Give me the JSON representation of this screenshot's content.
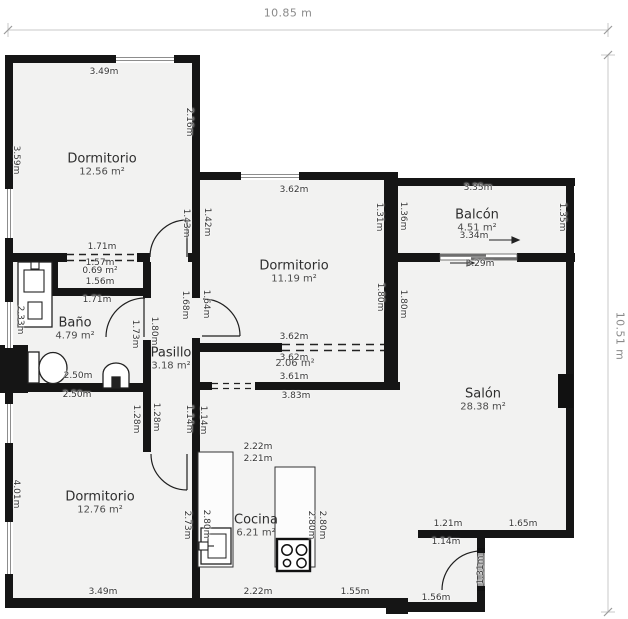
{
  "colors": {
    "wall": "#151515",
    "floor": "#f2f2f1",
    "dim_text": "#353535",
    "outer_dim_text": "#8a8a8a"
  },
  "outer_dimensions": {
    "width": "10.85 m",
    "height": "10.51 m"
  },
  "rooms": [
    {
      "name": "Dormitorio",
      "area": "12.56 m²",
      "x": 102,
      "y": 165
    },
    {
      "name": "Dormitorio",
      "area": "11.19 m²",
      "x": 294,
      "y": 272
    },
    {
      "name": "Balcón",
      "area": "4.51 m²",
      "x": 477,
      "y": 221
    },
    {
      "name": "Baño",
      "area": "4.79 m²",
      "x": 75,
      "y": 329
    },
    {
      "name": "Pasillo",
      "area": "3.18 m²",
      "x": 171,
      "y": 359
    },
    {
      "name": "Salón",
      "area": "28.38 m²",
      "x": 483,
      "y": 400
    },
    {
      "name": "Cocina",
      "area": "6.21 m²",
      "x": 256,
      "y": 526
    },
    {
      "name": "Dormitorio",
      "area": "12.76 m²",
      "x": 100,
      "y": 503
    },
    {
      "name": "",
      "area": "2.06 m²",
      "x": 295,
      "y": 364
    }
  ],
  "dims": [
    {
      "t": "10.85 m",
      "x": 288,
      "y": 13,
      "c": "outer"
    },
    {
      "t": "10.51 m",
      "x": 620,
      "y": 336,
      "v": 1,
      "c": "outer"
    },
    {
      "t": "3.49m",
      "x": 104,
      "y": 72
    },
    {
      "t": "2.16m",
      "x": 189,
      "y": 122,
      "v": 1
    },
    {
      "t": "3.59m",
      "x": 16,
      "y": 160,
      "v": 1
    },
    {
      "t": "1.71m",
      "x": 102,
      "y": 247
    },
    {
      "t": "1.57m",
      "x": 100,
      "y": 263
    },
    {
      "t": "0.69 m²",
      "x": 100,
      "y": 271
    },
    {
      "t": "1.56m",
      "x": 100,
      "y": 282
    },
    {
      "t": "1.71m",
      "x": 97,
      "y": 300
    },
    {
      "t": "1.43m",
      "x": 186,
      "y": 223,
      "v": 1
    },
    {
      "t": "1.42m",
      "x": 207,
      "y": 222,
      "v": 1
    },
    {
      "t": "3.62m",
      "x": 294,
      "y": 190
    },
    {
      "t": "1.31m",
      "x": 379,
      "y": 217,
      "v": 1
    },
    {
      "t": "1.36m",
      "x": 403,
      "y": 216,
      "v": 1
    },
    {
      "t": "3.35m",
      "x": 478,
      "y": 188
    },
    {
      "t": "1.35m",
      "x": 562,
      "y": 217,
      "v": 1
    },
    {
      "t": "3.34m",
      "x": 474,
      "y": 236
    },
    {
      "t": "3.29m",
      "x": 480,
      "y": 264
    },
    {
      "t": "2.33m",
      "x": 20,
      "y": 320,
      "v": 1
    },
    {
      "t": "1.80m",
      "x": 154,
      "y": 331,
      "v": 1
    },
    {
      "t": "1.73m",
      "x": 135,
      "y": 334,
      "v": 1
    },
    {
      "t": "1.68m",
      "x": 185,
      "y": 305,
      "v": 1
    },
    {
      "t": "1.64m",
      "x": 206,
      "y": 304,
      "v": 1
    },
    {
      "t": "1.80m",
      "x": 380,
      "y": 297,
      "v": 1
    },
    {
      "t": "1.80m",
      "x": 403,
      "y": 304,
      "v": 1
    },
    {
      "t": "3.62m",
      "x": 294,
      "y": 337
    },
    {
      "t": "3.62m",
      "x": 294,
      "y": 358
    },
    {
      "t": "3.61m",
      "x": 294,
      "y": 377
    },
    {
      "t": "3.83m",
      "x": 296,
      "y": 396
    },
    {
      "t": "2.50m",
      "x": 78,
      "y": 376
    },
    {
      "t": "2.50m",
      "x": 77,
      "y": 395
    },
    {
      "t": "1.28m",
      "x": 136,
      "y": 419,
      "v": 1
    },
    {
      "t": "1.28m",
      "x": 156,
      "y": 417,
      "v": 1
    },
    {
      "t": "1.14m",
      "x": 189,
      "y": 419,
      "v": 1
    },
    {
      "t": "1.14m",
      "x": 203,
      "y": 420,
      "v": 1
    },
    {
      "t": "4.01m",
      "x": 16,
      "y": 494,
      "v": 1
    },
    {
      "t": "2.22m",
      "x": 258,
      "y": 447
    },
    {
      "t": "2.21m",
      "x": 258,
      "y": 459
    },
    {
      "t": "2.73m",
      "x": 187,
      "y": 525,
      "v": 1
    },
    {
      "t": "2.80m",
      "x": 206,
      "y": 524,
      "v": 1
    },
    {
      "t": "2.80m",
      "x": 311,
      "y": 525,
      "v": 1
    },
    {
      "t": "2.80m",
      "x": 322,
      "y": 525,
      "v": 1
    },
    {
      "t": "2.22m",
      "x": 258,
      "y": 592
    },
    {
      "t": "1.55m",
      "x": 355,
      "y": 592
    },
    {
      "t": "3.49m",
      "x": 103,
      "y": 592
    },
    {
      "t": "1.21m",
      "x": 448,
      "y": 524
    },
    {
      "t": "1.65m",
      "x": 523,
      "y": 524
    },
    {
      "t": "1.14m",
      "x": 446,
      "y": 542
    },
    {
      "t": "1.31m",
      "x": 481,
      "y": 570,
      "v": 2
    },
    {
      "t": "1.56m",
      "x": 436,
      "y": 598
    }
  ]
}
